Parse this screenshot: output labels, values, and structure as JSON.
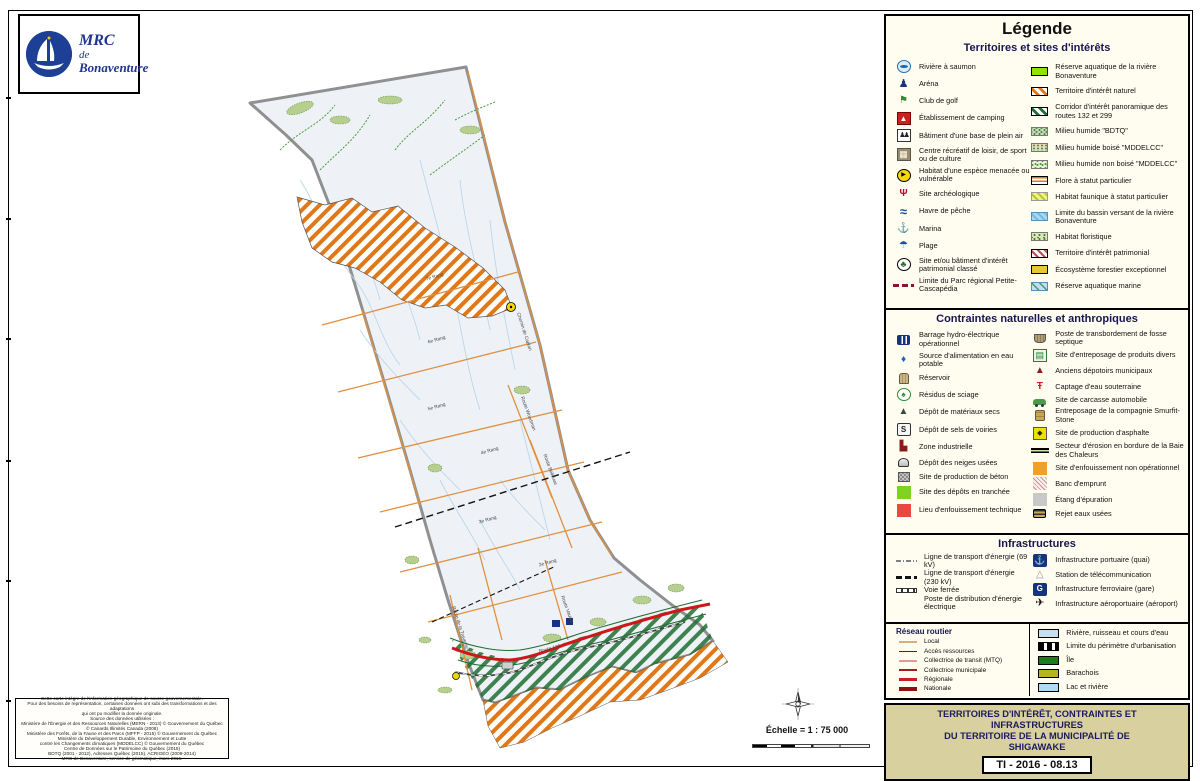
{
  "palette": {
    "navy": "#1c2f7c",
    "ivory": "#fffdf0",
    "beige": "#d9d0a0",
    "boundary_grey": "#909090",
    "hatch_orange": "#e07818",
    "corridor_green": "#1f6e32",
    "route_national_red": "#cc1818"
  },
  "logo": {
    "line1": "MRC",
    "line2": "de",
    "line3": "Bonaventure"
  },
  "map": {
    "scale_text": "Échelle = 1 : 75 000",
    "labels": [
      {
        "t": "7e Rang",
        "x": 435,
        "y": 278,
        "r": -16
      },
      {
        "t": "6e Rang",
        "x": 437,
        "y": 341,
        "r": -16
      },
      {
        "t": "5e Rang",
        "x": 437,
        "y": 408,
        "r": -16
      },
      {
        "t": "4e Rang",
        "x": 490,
        "y": 452,
        "r": -16
      },
      {
        "t": "3e Rang",
        "x": 488,
        "y": 521,
        "r": -16
      },
      {
        "t": "2e Rang",
        "x": 548,
        "y": 564,
        "r": -16
      },
      {
        "t": "Chemin de Caplan",
        "x": 523,
        "y": 332,
        "r": 72
      },
      {
        "t": "Route Woodman",
        "x": 527,
        "y": 414,
        "r": 70
      },
      {
        "t": "Route Bellevue",
        "x": 549,
        "y": 470,
        "r": 70
      },
      {
        "t": "Route Vautier",
        "x": 566,
        "y": 610,
        "r": 70
      },
      {
        "t": "Route de la Traverse",
        "x": 459,
        "y": 628,
        "r": 72
      },
      {
        "t": "Route 132",
        "x": 550,
        "y": 650,
        "r": -14
      }
    ]
  },
  "attribution": {
    "lines": [
      "Cette carte intègre de l'information géographique de source gouvernementale.",
      "Pour des besoins de représentation, certaines données ont subi des transformations et des adaptations",
      "qui ont pu modifier la donnée originale.",
      "Source des données utilisées :",
      "Ministère de l'Énergie et des Ressources Naturelles (MERN - 2013) © Gouvernement du Québec",
      "© Canards Illimités Canada (2008)",
      "Ministère des Forêts, de la Faune et des Parcs (MFFP - 2015) © Gouvernement du Québec",
      "Ministère du Développement Durable, Environnement et Lutte",
      "contre les Changements climatiques (MDDELCC) © Gouvernement du Québec",
      "Centre de Données sur le Patrimoine du Québec (2015)",
      "BDTQ (2001 - 2012), Adresses Québec (2015), ACRIGÉO (2009-2014)",
      "MRC de Bonaventure, service de géomatique, mars 2016."
    ]
  },
  "legend": {
    "title": "Légende",
    "sections": [
      {
        "title": "Territoires et sites d'intérêts",
        "left": [
          {
            "icon": "salmon-river-icon",
            "label": "Rivière à saumon"
          },
          {
            "icon": "arena-icon",
            "label": "Aréna"
          },
          {
            "icon": "golf-club-icon",
            "label": "Club de golf"
          },
          {
            "icon": "camping-icon",
            "label": "Établissement de camping"
          },
          {
            "icon": "outdoor-base-icon",
            "label": "Bâtiment d'une base de plein air"
          },
          {
            "icon": "recreation-centre-icon",
            "label": "Centre récréatif de loisir, de sport ou de culture"
          },
          {
            "icon": "endangered-species-icon",
            "label": "Habitat d'une espèce menacée ou vulnérable"
          },
          {
            "icon": "archaeological-site-icon",
            "label": "Site archéologique"
          },
          {
            "icon": "fishing-harbour-icon",
            "label": "Havre de pêche"
          },
          {
            "icon": "marina-icon",
            "label": "Marina"
          },
          {
            "icon": "beach-icon",
            "label": "Plage"
          },
          {
            "icon": "heritage-building-icon",
            "label": "Site et/ou bâtiment d'intérêt patrimonial classé"
          },
          {
            "icon": "regional-park-limit-icon",
            "label": "Limite du Parc régional Petite-Cascapédia"
          }
        ],
        "right": [
          {
            "icon": "aquatic-reserve-swatch",
            "label": "Réserve aquatique de la rivière Bonaventure"
          },
          {
            "icon": "natural-interest-swatch",
            "label": "Territoire d'intérêt naturel"
          },
          {
            "icon": "panoramic-corridor-swatch",
            "label": "Corridor d'intérêt panoramique des routes 132 et 299"
          },
          {
            "icon": "wetland-bdtq-swatch",
            "label": "Milieu humide \"BDTQ\""
          },
          {
            "icon": "wetland-wooded-swatch",
            "label": "Milieu humide boisé \"MDDELCC\""
          },
          {
            "icon": "wetland-open-swatch",
            "label": "Milieu humide non boisé \"MDDELCC\""
          },
          {
            "icon": "flora-status-swatch",
            "label": "Flore à statut particulier"
          },
          {
            "icon": "fauna-habitat-swatch",
            "label": "Habitat faunique à statut particulier"
          },
          {
            "icon": "watershed-limit-swatch",
            "label": "Limite du bassin versant de la rivière Bonaventure"
          },
          {
            "icon": "floristic-habitat-swatch",
            "label": "Habitat floristique"
          },
          {
            "icon": "heritage-territory-swatch",
            "label": "Territoire d'intérêt patrimonial"
          },
          {
            "icon": "forest-ecosystem-swatch",
            "label": "Écosystème forestier exceptionnel"
          },
          {
            "icon": "marine-reserve-swatch",
            "label": "Réserve aquatique marine"
          }
        ]
      },
      {
        "title": "Contraintes naturelles et anthropiques",
        "left": [
          {
            "icon": "hydro-dam-icon",
            "label": "Barrage hydro-électrique opérationnel"
          },
          {
            "icon": "drinking-water-icon",
            "label": "Source d'alimentation en eau potable"
          },
          {
            "icon": "reservoir-icon",
            "label": "Réservoir"
          },
          {
            "icon": "sawdust-icon",
            "label": "Résidus de sciage"
          },
          {
            "icon": "dry-materials-icon",
            "label": "Dépôt de matériaux secs"
          },
          {
            "icon": "road-salt-icon",
            "label": "Dépôt de sels de voiries"
          },
          {
            "icon": "industrial-zone-icon",
            "label": "Zone industrielle"
          },
          {
            "icon": "snow-dump-icon",
            "label": "Dépôt des neiges usées"
          },
          {
            "icon": "concrete-plant-icon",
            "label": "Site de production de béton"
          },
          {
            "icon": "trench-deposit-swatch",
            "label": "Site des dépôts en tranchée"
          },
          {
            "icon": "technical-landfill-swatch",
            "label": "Lieu d'enfouissement technique"
          }
        ],
        "right": [
          {
            "icon": "septic-transfer-icon",
            "label": "Poste de transbordement de fosse septique"
          },
          {
            "icon": "products-storage-icon",
            "label": "Site d'entreposage de produits divers"
          },
          {
            "icon": "old-dump-icon",
            "label": "Anciens dépotoirs municipaux"
          },
          {
            "icon": "groundwater-capture-icon",
            "label": "Captage d'eau souterraine"
          },
          {
            "icon": "car-carcass-icon",
            "label": "Site de carcasse automobile"
          },
          {
            "icon": "smurfit-storage-icon",
            "label": "Entreposage de la compagnie Smurfit-Stone"
          },
          {
            "icon": "asphalt-plant-icon",
            "label": "Site de production d'asphalte"
          },
          {
            "icon": "erosion-sector-icon",
            "label": "Secteur d'érosion en bordure de la Baie des Chaleurs"
          },
          {
            "icon": "closed-landfill-swatch",
            "label": "Site d'enfouissement non opérationnel"
          },
          {
            "icon": "borrow-pit-swatch",
            "label": "Banc d'emprunt"
          },
          {
            "icon": "treatment-pond-swatch",
            "label": "Étang d'épuration"
          },
          {
            "icon": "wastewater-outfall-icon",
            "label": "Rejet eaux usées"
          }
        ]
      },
      {
        "title": "Infrastructures",
        "left": [
          {
            "icon": "power-line-69-icon",
            "label": "Ligne de transport d'énergie (69 kV)"
          },
          {
            "icon": "power-line-230-icon",
            "label": "Ligne de transport d'énergie (230 kV)"
          },
          {
            "icon": "railway-icon",
            "label": "Voie ferrée"
          },
          {
            "icon": "power-station-swatch",
            "label": "Poste de distribution d'énergie électrique"
          }
        ],
        "right": [
          {
            "icon": "port-icon",
            "label": "Infrastructure portuaire (quai)"
          },
          {
            "icon": "telecom-station-icon",
            "label": "Station de télécommunication"
          },
          {
            "icon": "train-station-icon",
            "label": "Infrastructure ferroviaire (gare)"
          },
          {
            "icon": "airport-icon",
            "label": "Infrastructure aéroportuaire (aéroport)"
          }
        ]
      },
      {
        "title": "Réseau routier",
        "left": [
          {
            "icon": "road-local-line",
            "label": "Local"
          },
          {
            "icon": "road-access-line",
            "label": "Accès ressources"
          },
          {
            "icon": "road-mtq-line",
            "label": "Collectrice de transit (MTQ)"
          },
          {
            "icon": "road-municipal-line",
            "label": "Collectrice municipale"
          },
          {
            "icon": "road-regional-line",
            "label": "Régionale"
          },
          {
            "icon": "road-national-line",
            "label": "Nationale"
          }
        ],
        "right": [
          {
            "icon": "watercourse-line",
            "label": "Rivière, ruisseau et cours d'eau"
          },
          {
            "icon": "urban-perimeter-line",
            "label": "Limite du périmètre d'urbanisation"
          },
          {
            "icon": "island-swatch",
            "label": "Île"
          },
          {
            "icon": "barachois-swatch",
            "label": "Barachois"
          },
          {
            "icon": "lake-river-swatch",
            "label": "Lac et rivière"
          }
        ]
      }
    ],
    "title_block": {
      "lines": [
        "TERRITOIRES D'INTÉRÊT, CONTRAINTES ET INFRASTRUCTURES",
        "DU TERRITOIRE DE LA MUNICIPALITÉ DE",
        "SHIGAWAKE"
      ],
      "code": "TI - 2016 - 08.13"
    }
  }
}
